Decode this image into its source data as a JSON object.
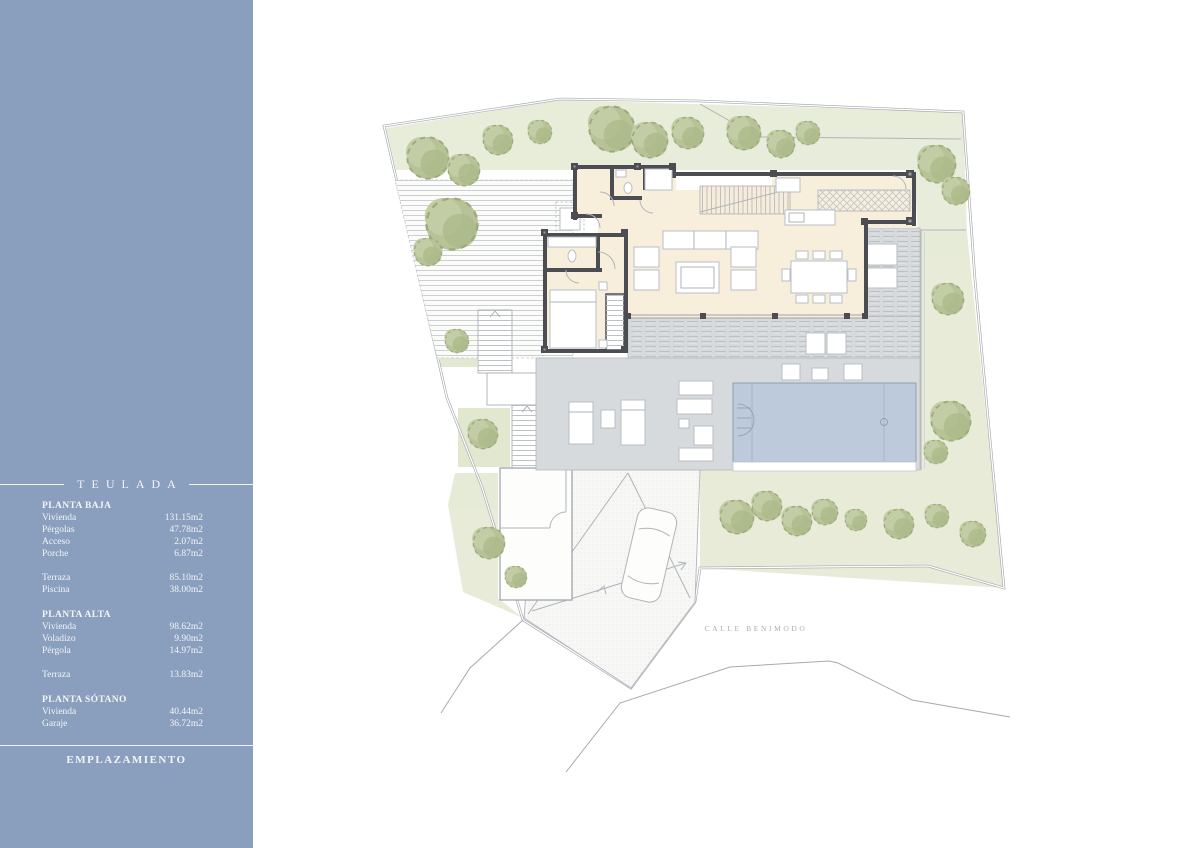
{
  "sidebar": {
    "title": "TEULADA",
    "footer_label": "EMPLAZAMIENTO",
    "sections": [
      {
        "heading": "PLANTA BAJA",
        "rows": [
          {
            "label": "Vivienda",
            "value": "131.15m2"
          },
          {
            "label": "Pérgolas",
            "value": "47.78m2"
          },
          {
            "label": "Acceso",
            "value": "2.07m2"
          },
          {
            "label": "Porche",
            "value": "6.87m2"
          },
          {
            "label": "Terraza",
            "value": "85.10m2"
          },
          {
            "label": "Piscina",
            "value": "38.00m2"
          }
        ]
      },
      {
        "heading": "PLANTA ALTA",
        "rows": [
          {
            "label": "Vivienda",
            "value": "98.62m2"
          },
          {
            "label": "Voladizo",
            "value": "9.90m2"
          },
          {
            "label": "Pérgola",
            "value": "14.97m2"
          },
          {
            "label": "Terraza",
            "value": "13.83m2"
          }
        ]
      },
      {
        "heading": "PLANTA SÓTANO",
        "rows": [
          {
            "label": "Vivienda",
            "value": "40.44m2"
          },
          {
            "label": "Garaje",
            "value": "36.72m2"
          }
        ]
      }
    ],
    "colors": {
      "background": "#8A9FBD",
      "text": "#F2F5F8"
    }
  },
  "plan": {
    "street_label": "CALLE BENIMODO",
    "drawing_type": "site-plan",
    "colors": {
      "walls": "#4C4D52",
      "interior": "#F8EEDC",
      "terrace": "#D7DADD",
      "pool": "#BCCADC",
      "vegetation": "#E5EAD5",
      "trees": "#B7C397",
      "boundary": "#9FA4A8"
    }
  }
}
